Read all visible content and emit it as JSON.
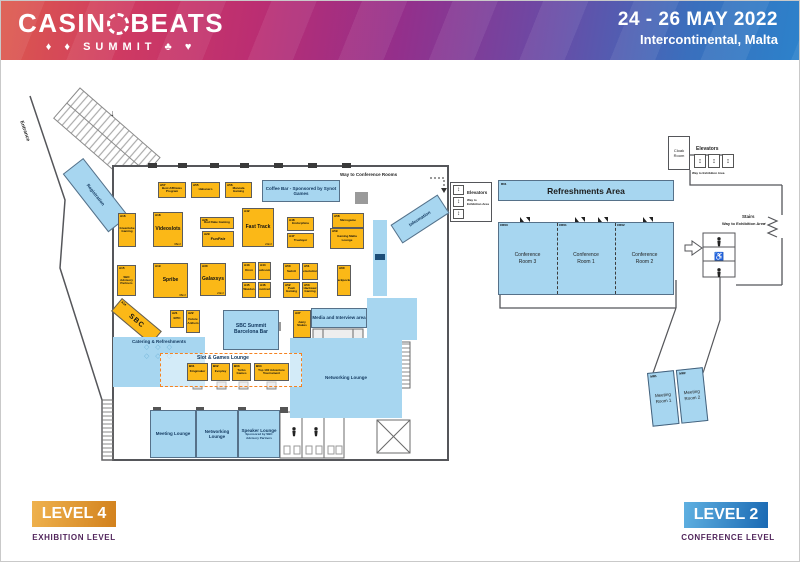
{
  "header": {
    "logo_pre": "CASIN",
    "logo_post": "BEATS",
    "logo_line2": "SUMMIT",
    "suits_left": "♦ ♦",
    "suits_right": "♣ ♥",
    "date": "24 - 26 MAY 2022",
    "venue": "Intercontinental, Malta"
  },
  "icons": {
    "down_arrow": "↓",
    "right_arrow": "→",
    "elevator": "↕",
    "wheelchair": "♿"
  },
  "level4": {
    "badge": "LEVEL 4",
    "badge_sub": "EXHIBITION LEVEL",
    "labels": {
      "entrance": "Entrance",
      "registration": "Registration",
      "information": "Information",
      "way_to_conference": "Way to Conference Rooms",
      "coffee_bar": "Coffee Bar - Sponsored by Synot Games",
      "catering": "Catering & Refreshments",
      "tables_row": "◇ ◇ ◇",
      "slot_lounge": "Slot & Games Lounge",
      "networking_lounge": "Networking Lounge",
      "media_area": "Media and Interview area",
      "sbc_bar": "SBC Summit Barcelona Bar",
      "meeting_lounge": "Meeting Lounge",
      "networking_lounge2": "Networking Lounge",
      "speaker_lounge": "Speaker Lounge",
      "speaker_lounge_sub": "Sponsored by SBC Advisory Partners"
    },
    "booths": [
      {
        "code": "A57",
        "name": "Best Affiliates Program"
      },
      {
        "code": "A55",
        "name": "Habanero"
      },
      {
        "code": "A56",
        "name": "Mancala Gaming"
      },
      {
        "code": "A16",
        "name": "Greentube Gaming"
      },
      {
        "code": "A18",
        "name": "Videoslots",
        "size": "36m²"
      },
      {
        "code": "A28",
        "name": "Red Rake Gaming"
      },
      {
        "code": "A29",
        "name": "FunFair"
      },
      {
        "code": "A42",
        "name": "Fast Track",
        "size": "24m²"
      },
      {
        "code": "A48",
        "name": "Endorphina"
      },
      {
        "code": "A47",
        "name": "Truelayer"
      },
      {
        "code": "A58",
        "name": "Microgame"
      },
      {
        "code": "A59",
        "name": "Gaming Malta Lounge"
      },
      {
        "code": "A15",
        "name": "SBC Advisory Partners"
      },
      {
        "code": "A19",
        "name": "Spribe",
        "size": "36m²"
      },
      {
        "code": "A30",
        "name": "Galaxsys",
        "size": "24m²"
      },
      {
        "code": "A43",
        "name": "Kiron"
      },
      {
        "code": "A44",
        "name": "Lucksome"
      },
      {
        "code": "A45",
        "name": "Wazdan"
      },
      {
        "code": "A46",
        "name": "Comtrade"
      },
      {
        "code": "A50",
        "name": "Swintt"
      },
      {
        "code": "A51",
        "name": "Betsolutions"
      },
      {
        "code": "A52",
        "name": "Push Gaming"
      },
      {
        "code": "A53",
        "name": "Hacksaw Gaming"
      },
      {
        "code": "A60",
        "name": "Jackpocket"
      },
      {
        "code": "A37",
        "name": "Juicy Stakes"
      },
      {
        "code": "A21",
        "name": "EPIC"
      },
      {
        "code": "A22",
        "name": "Future Anthem"
      },
      {
        "code": "A14",
        "name": "SBC"
      },
      {
        "code": "B01",
        "name": "Kingmaker"
      },
      {
        "code": "B02",
        "name": "Evoplay"
      },
      {
        "code": "B03",
        "name": "Turbo Games"
      },
      {
        "code": "B04",
        "name": "Top 100 Adventure Tournament"
      }
    ]
  },
  "level2": {
    "badge": "LEVEL 2",
    "badge_sub": "CONFERENCE LEVEL",
    "labels": {
      "cloak_room": "Cloak Room",
      "elevators_top": "Elevators",
      "way_exhibit_top": "Way to Exhibition Area",
      "elevators_left": "Elevators",
      "way_exhibit_left": "Way to Exhibition Area",
      "stairs": "Stairs",
      "way_exhibit_right": "Way to Exhibition Area",
      "refreshments": "Refreshments Area",
      "refreshments_code": "R01"
    },
    "rooms": [
      {
        "code": "CR03",
        "name": "Conference Room 3"
      },
      {
        "code": "CR01",
        "name": "Conference Room 1"
      },
      {
        "code": "CR02",
        "name": "Conference Room 2"
      }
    ],
    "meeting_rooms": [
      {
        "code": "MR1",
        "name": "Meeting Room 1"
      },
      {
        "code": "MR2",
        "name": "Meeting Room 2"
      }
    ]
  }
}
